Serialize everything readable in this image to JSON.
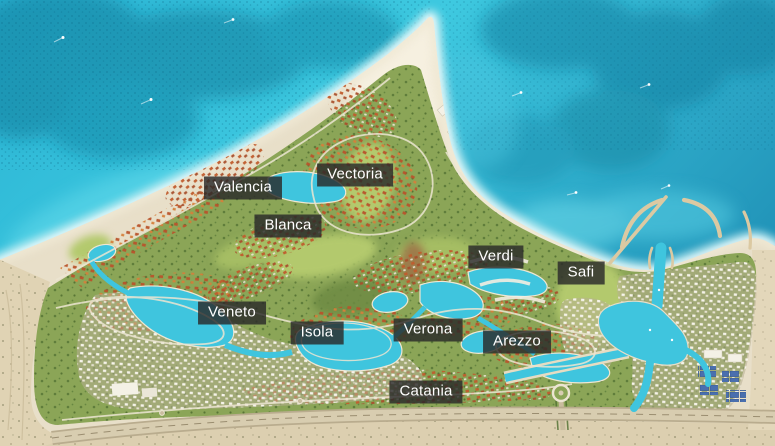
{
  "map": {
    "description": "Aerial masterplan map of a coastal resort community on a sandy spit, with golf courses, lagoons, villa districts, a marina with breakwaters, and a highway along the southern edge",
    "region_labels": [
      {
        "text": "Valencia",
        "x": 243,
        "y": 188
      },
      {
        "text": "Vectoria",
        "x": 355,
        "y": 175
      },
      {
        "text": "Blanca",
        "x": 288,
        "y": 226
      },
      {
        "text": "Verdi",
        "x": 496,
        "y": 257
      },
      {
        "text": "Safi",
        "x": 581,
        "y": 273
      },
      {
        "text": "Veneto",
        "x": 232,
        "y": 313
      },
      {
        "text": "Isola",
        "x": 317,
        "y": 333
      },
      {
        "text": "Verona",
        "x": 428,
        "y": 330
      },
      {
        "text": "Arezzo",
        "x": 517,
        "y": 342
      },
      {
        "text": "Catania",
        "x": 426,
        "y": 392
      }
    ],
    "label_style": {
      "background": "rgba(42,42,42,0.82)",
      "text_color": "#ffffff"
    },
    "colors": {
      "sea_deep": "#2193b8",
      "sea_mid": "#2ab4d4",
      "sea_bright": "#3ec9e0",
      "shallow": "#cdf1f5",
      "sand": "#e8dfc9",
      "sand_bright": "#f6f0e0",
      "desert": "#e0d3b4",
      "green": "#8ba557",
      "green_light": "#b3c96d",
      "green_dark": "#4e6e31",
      "lagoon": "#3fc5de",
      "villa_roof": "#b9542c",
      "villa_roof_light": "#d57f3b",
      "town_white": "#f4f1e6",
      "road": "#ece5d2",
      "highway": "#c2b597",
      "breakwater": "#dbc9a2",
      "solar_panel": "#4a6fae"
    }
  }
}
